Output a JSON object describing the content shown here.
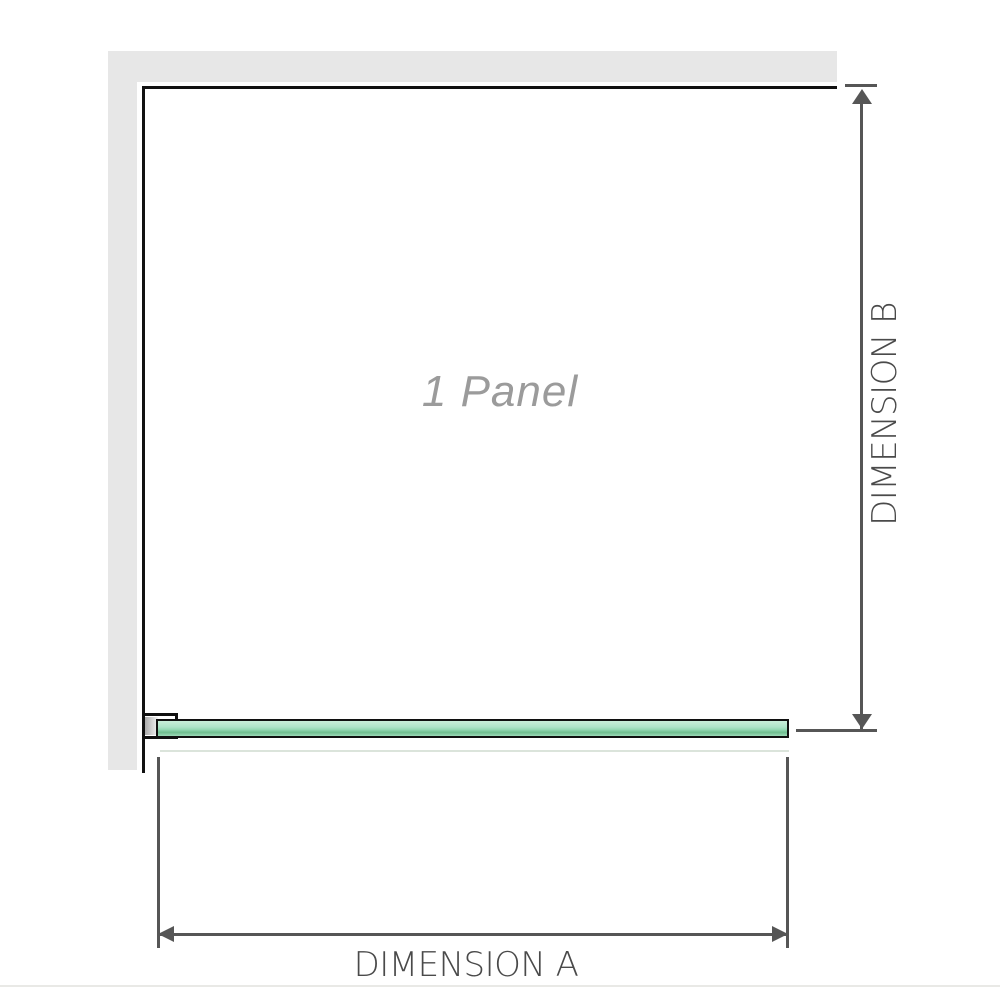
{
  "diagram": {
    "panel_label": "1 Panel",
    "dimensions": {
      "a": {
        "label": "DIMENSION A"
      },
      "b": {
        "label": "DIMENSION B"
      }
    },
    "colors": {
      "wall_fill": "#e7e7e7",
      "outline": "#111111",
      "glass_green": "#aee3c8",
      "glass_green_dark": "#6fbe8f",
      "bracket_insert_gray": "#ababab",
      "dimension_line": "#565656",
      "dimension_text": "#4a4a4a",
      "panel_label_text": "#9b9b9b",
      "footer_rule": "#e9e9e6"
    }
  }
}
